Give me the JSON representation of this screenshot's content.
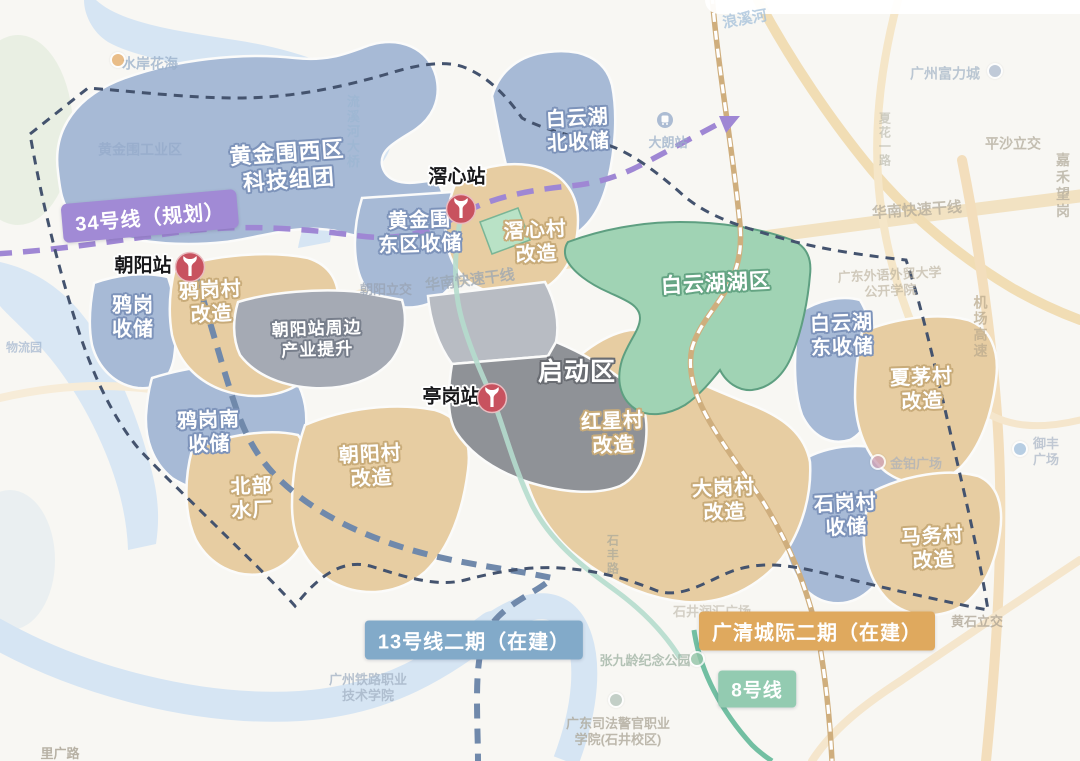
{
  "badges": {
    "line34": "34号线（规划）",
    "line13": "13号线二期（在建）",
    "guangqing_intercity": "广清城际二期（在建）",
    "line8": "8号线"
  },
  "stations": {
    "jiaoxin": "滘心站",
    "chaoyang": "朝阳站",
    "tinggang": "亭岗站"
  },
  "regions": {
    "huangjinwei_west": "黄金围西区\n科技组团",
    "baiyunhu_north": "白云湖\n北收储",
    "huangjinwei_east": "黄金围\n东区收储",
    "jiaoxin_village": "滘心村\n改造",
    "baiyunhu_lake": "白云湖湖区",
    "baiyunhu_east": "白云湖\n东收储",
    "xiamao_village": "夏茅村\n改造",
    "yagang_reserve": "鸦岗\n收储",
    "yagang_village": "鸦岗村\n改造",
    "chaoyang_industry": "朝阳站周边\n产业提升",
    "launch_zone": "启动区",
    "yagang_south": "鸦岗南\n收储",
    "beibu_waterworks": "北部\n水厂",
    "chaoyang_village": "朝阳村\n改造",
    "hongxing_village": "红星村\n改造",
    "dagang_village": "大岗村\n改造",
    "shigang_village": "石岗村\n收储",
    "mawu_village": "马务村\n改造"
  },
  "background_labels": {
    "shuian_huahai": "水岸花海",
    "langxi_river": "浪溪河",
    "huangjinwei_industrial": "黄金围工业区",
    "liuxihe_bridge": "流溪河大桥",
    "chaoyang_interchange": "朝阳立交",
    "huanan_expressway": "华南快速干线",
    "pingsha_interchange": "平沙立交",
    "jiahe_wanggang": "嘉禾望岗",
    "airport_expressway": "机场高速",
    "xiahua_road": "夏花一路",
    "fuli_city": "广州富力城",
    "dalang_station": "大朗站",
    "gdufs_college": "广东外语外贸大学\n公开学院",
    "jinbo_plaza": "金铂广场",
    "yufeng_plaza": "御丰广场",
    "huangshi_interchange": "黄石立交",
    "shijing_plaza": "石井润汇广场",
    "zhangjiuling_park": "张九龄纪念公园",
    "railway_college": "广州铁路职业\n技术学院",
    "justice_college": "广东司法警官职业\n学院(石井校区)",
    "liguang_road": "里广路",
    "shifeng_road": "石丰路",
    "logistics_park": "物流园"
  },
  "colors": {
    "region_blue": "#a7bad6",
    "region_tan": "#e7cda2",
    "region_gray": "#a5aab4",
    "launch_gray": "#8f9297",
    "lake_green": "#a0d3b4",
    "line34_purple": "#9f87d4",
    "line13_blue": "#7089ab",
    "intercity_orange": "#dfa95e",
    "line8_green": "#93cbb1",
    "boundary_navy": "#44536e",
    "metro_red": "#c8525f"
  }
}
